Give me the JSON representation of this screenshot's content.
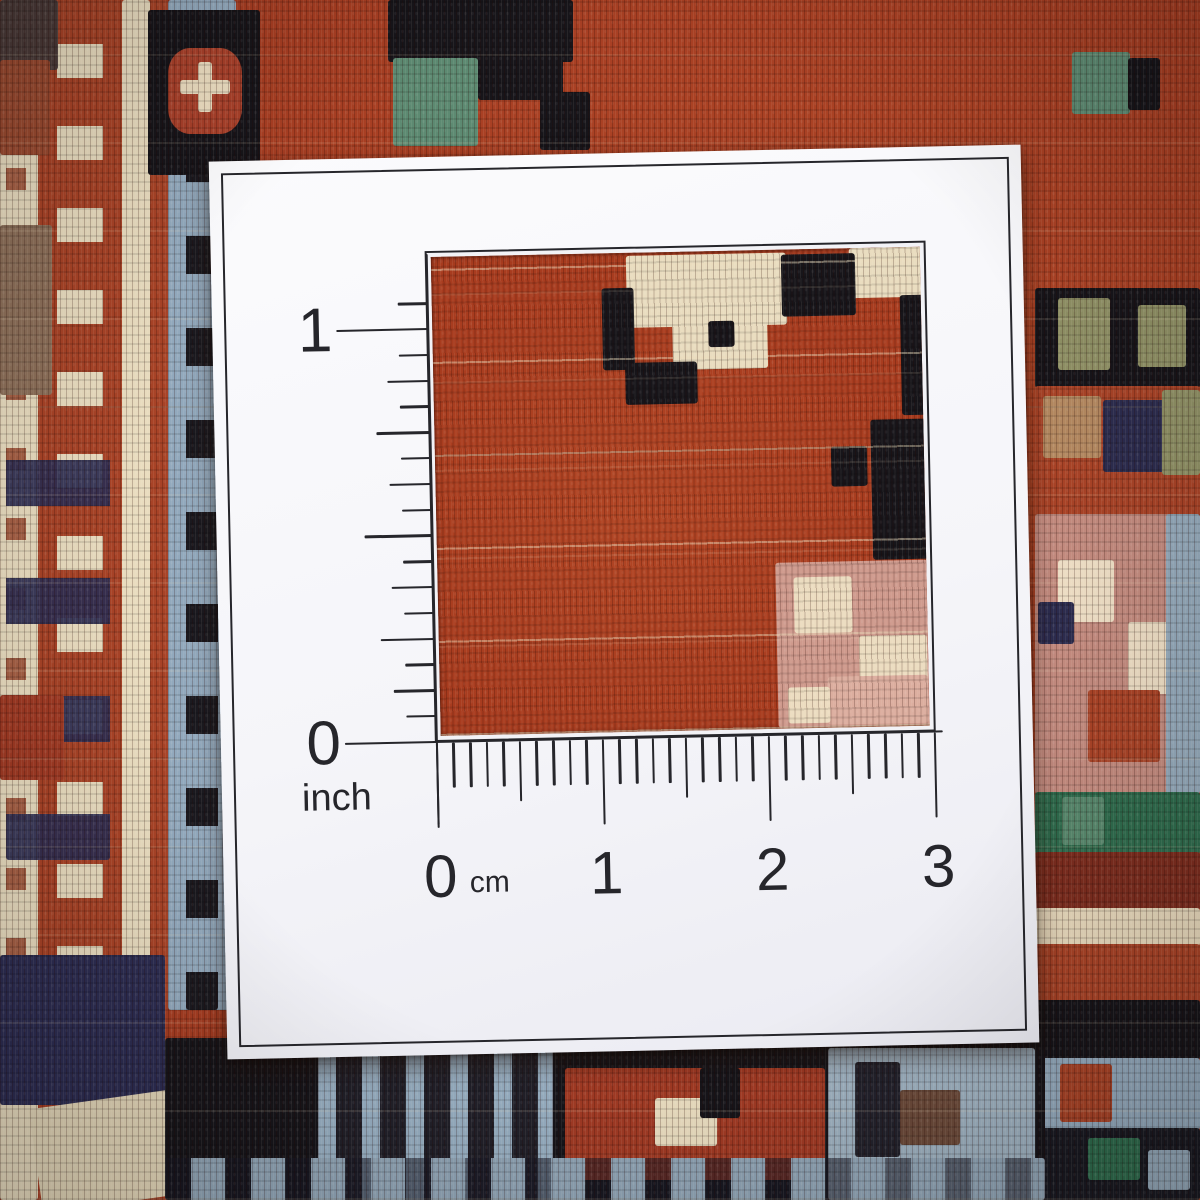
{
  "measurement_card": {
    "inch_ruler": {
      "one": "1",
      "zero": "0",
      "unit": "inch"
    },
    "cm_ruler": {
      "zero": "0",
      "one": "1",
      "two": "2",
      "three": "3",
      "unit": "cm"
    }
  },
  "palette": {
    "card_white": "#f8f8fb",
    "ink": "#26262b",
    "rug_red": "#a63d22",
    "rug_cream": "#e9dcbf",
    "rug_black": "#17151a",
    "rug_light_blue": "#92a9bd",
    "rug_navy": "#2d2d52",
    "rug_teal": "#5d8a72",
    "rug_green": "#2f6b4d",
    "rug_rose": "#c28a7e",
    "rug_pink": "#cf9a8d",
    "rug_olive": "#8f9065",
    "rug_tan": "#b38860",
    "rug_maroon": "#7c2d1f"
  }
}
